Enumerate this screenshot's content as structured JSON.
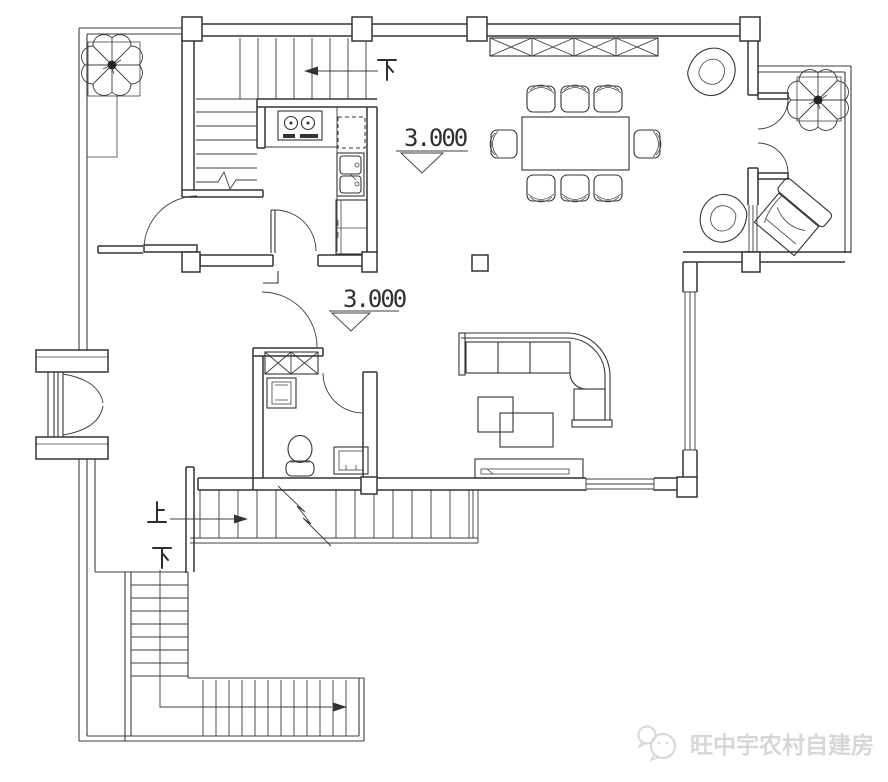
{
  "plan": {
    "background": "#ffffff",
    "line_color": "#333333",
    "elevation_markers": [
      {
        "value": "3.000"
      },
      {
        "value": "3.000"
      }
    ],
    "stair_labels": {
      "upper_down": "下",
      "main_up": "上",
      "exterior_down": "下"
    },
    "watermark": {
      "icon": "wechat-icon",
      "text": "旺中宇农村自建房",
      "color": "#d7d7d7"
    }
  }
}
